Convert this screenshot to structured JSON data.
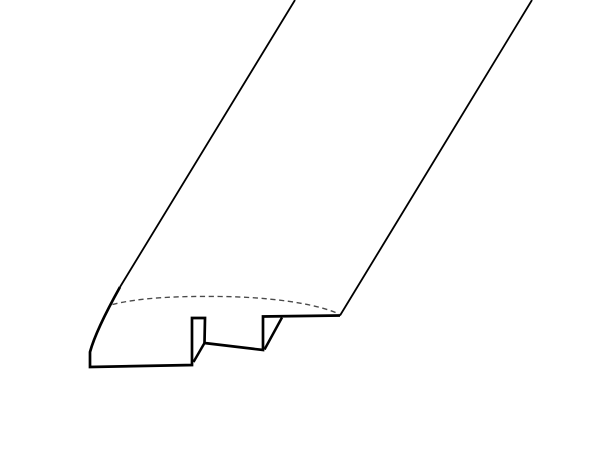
{
  "canvas": {
    "width": 600,
    "height": 461,
    "background": "#ffffff",
    "viewbox": "0 0 600 461"
  },
  "diagram": {
    "subject": "reducer-molding-profile-line-drawing",
    "stroke_color": "#000000",
    "dashed_color": "#4a4a4a",
    "paths": [
      {
        "name": "left-long-edge",
        "d": "M 295 0 L 120 287",
        "width": 1.8,
        "dashed": false,
        "dash": ""
      },
      {
        "name": "profile-outline",
        "d": "M 120 287 Q 96 330 90 352 L 90 367 L 192 365 L 192 318 L 205 318 L 204.5 343 L 263 350 L 263 316.5 L 340 315.5",
        "width": 2.7,
        "dashed": false,
        "dash": ""
      },
      {
        "name": "groove-left-wall-near-edge",
        "d": "M 204.5 343 L 193.5 362",
        "width": 2.5,
        "dashed": false,
        "dash": ""
      },
      {
        "name": "step-near-edge",
        "d": "M 282 317.5 L 264.5 349.5",
        "width": 2.5,
        "dashed": false,
        "dash": ""
      },
      {
        "name": "right-long-edge",
        "d": "M 532 0 L 340 315.5",
        "width": 1.8,
        "dashed": false,
        "dash": ""
      },
      {
        "name": "hidden-top-contour-edge",
        "d": "M 112.5 304.5 C 140 297.5 180 296 220 296.5 C 268 297 315 303 339 314",
        "width": 1.35,
        "dashed": true,
        "dash": "5.2 3.6"
      }
    ]
  }
}
